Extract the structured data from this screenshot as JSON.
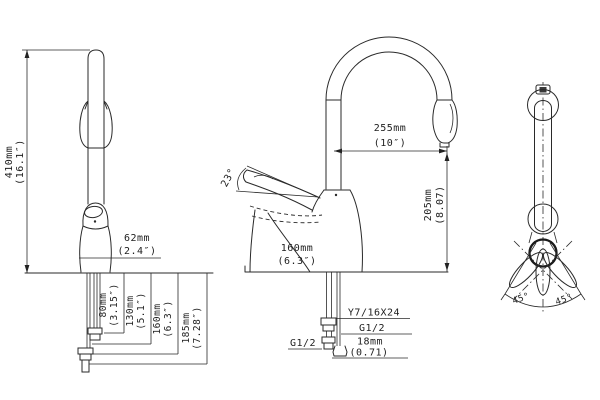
{
  "drawing_title": "faucet-dimension-drawing",
  "colors": {
    "line": "#2a2a2a",
    "background": "#ffffff"
  },
  "views": {
    "front": {
      "height_mm": "410mm",
      "height_in": "(16.1″)",
      "width_mm": "62mm",
      "width_in": "(2.4″)",
      "depths": [
        {
          "mm": "80mm",
          "in": "(3.15″)"
        },
        {
          "mm": "130mm",
          "in": "(5.1″)"
        },
        {
          "mm": "160mm",
          "in": "(6.3″)"
        },
        {
          "mm": "185mm",
          "in": "(7.28″)"
        }
      ]
    },
    "side": {
      "reach_mm": "255mm",
      "reach_in": "(10″)",
      "height_mm": "205mm",
      "height_in": "(8.07)",
      "handle_angle": "23°",
      "depth_mm": "160mm",
      "depth_in": "(6.3″)",
      "thread_spray": "Y7/16X24",
      "thread_hose": "G1/2",
      "thread_inlet": "G1/2",
      "shank_mm": "18mm",
      "shank_in": "(0.71)"
    },
    "rear": {
      "swivel_left": "45°",
      "swivel_right": "45°"
    }
  }
}
